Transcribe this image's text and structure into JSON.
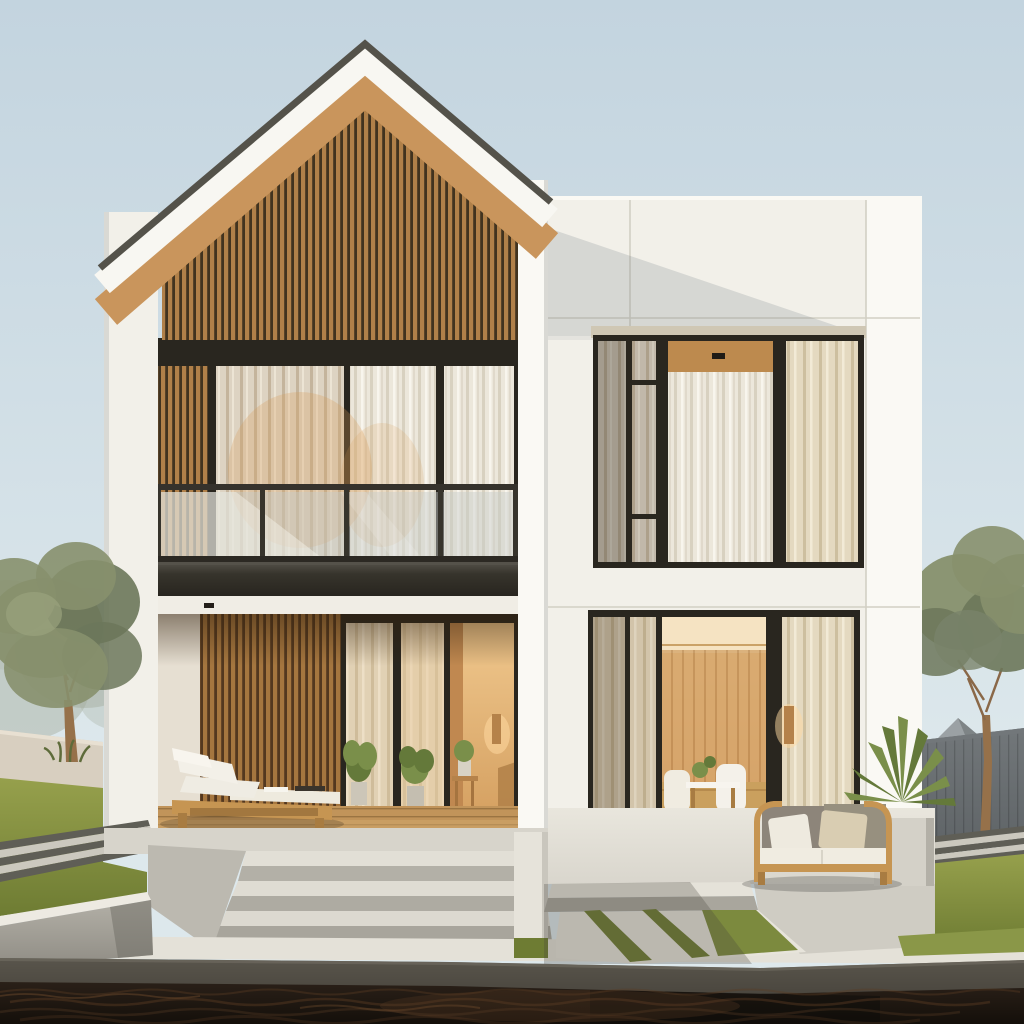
{
  "scene": {
    "type": "architectural-exterior-rendering",
    "subject": "Modern two-volume house: gabled wing with vertical wood slats and balcony on the left, flat-roof white wing with large curtained windows on the right, concrete steps and reflecting pool in front",
    "elements": [
      "sky",
      "gable roof",
      "wood slat gable",
      "balcony glass railing",
      "curtained windows",
      "covered porch",
      "chaise lounge",
      "outdoor sofa",
      "dining room interior",
      "wall sconce",
      "concrete steps",
      "grass planter",
      "striped walkway",
      "boundary wall",
      "dark fence",
      "trees",
      "potted plants",
      "reflecting pool"
    ]
  },
  "colors": {
    "sky_top": "#c3d4df",
    "sky_bottom": "#dde8ec",
    "wall_white": "#f2f0e9",
    "wall_bright": "#faf9f4",
    "wall_shade": "#d9d9d4",
    "wall_seam": "#d2cfc4",
    "roof_edge": "#54524a",
    "fascia": "#f8f7f2",
    "soffit_wood": "#c9955c",
    "slat_wood": "#b08049",
    "slat_gap": "#41331f",
    "porch_slat_wood": "#a5763f",
    "porch_slat_gap": "#53381f",
    "frame_dark": "#29261f",
    "curtain_light": "#ece7db",
    "curtain_stripe": "#d8d1c0",
    "curtain_warm": "#e4d9c0",
    "curtain_warm_stripe": "#cdbf9f",
    "curtain_shade": "#b8b2a4",
    "glass_tint": "#c7ccc9",
    "glass_reflection": "#f2efe6",
    "slab_dark": "#37342c",
    "slab_hi": "#55524a",
    "interior_glow": "#f2cf9a",
    "interior_warm": "#dfa870",
    "interior_wood": "#d2a166",
    "interior_wood_line": "#b9854b",
    "ceiling_light": "#f5e3c2",
    "deck_wood": "#c1945a",
    "deck_line": "#9a7442",
    "wood_furniture": "#c69552",
    "wood_furniture_dark": "#a87c42",
    "cushion_white": "#f0ece1",
    "cushion_gray": "#8d857a",
    "pillow_beige": "#d9cdb2",
    "concrete_light": "#e2dfd6",
    "concrete_mid": "#b3b0a7",
    "concrete_dark": "#8f8c84",
    "platform": "#d7d4cb",
    "grass": "#96a04c",
    "grass_dark": "#6e7c33",
    "path_dark": "#5f5e56",
    "path_light": "#cbc8be",
    "left_wall": "#d8cfc0",
    "fence": "#5f6467",
    "fence_light": "#72777a",
    "tree_leaf": "#87906d",
    "tree_leaf_dark": "#6c775a",
    "tree_mist": "#a9b1a4",
    "trunk": "#96714a",
    "neighbor_roof": "#9ba1a4",
    "neighbor_roof_dark": "#7e8486",
    "lintel_tan": "#cfc7b4",
    "water_top": "#2a2018",
    "water_deep": "#140f0a",
    "water_ripple": "#5a3c24",
    "edge_band": "#4a463e",
    "edge_band_light": "#6e6a60",
    "lamp_glow": "#ffd9a0",
    "plant_green": "#7a8f4a",
    "plant_green_dark": "#64793a",
    "warm_reflection": "#d89a55",
    "shadow_tint": "#46423a"
  }
}
